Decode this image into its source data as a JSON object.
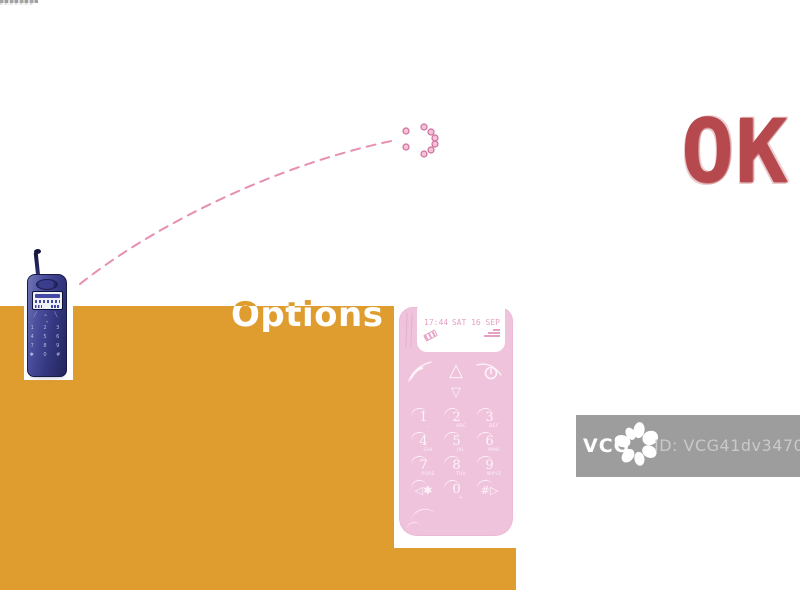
{
  "ok_label": "OK",
  "options_label": "Options",
  "emoticon": {
    "symbol": ":)"
  },
  "pink_phone": {
    "screen": {
      "time": "17:44",
      "date": "SAT 16 SEP"
    },
    "nav_up": "△",
    "nav_down": "▽",
    "keys": [
      {
        "num": "1",
        "sub": ".,"
      },
      {
        "num": "2",
        "sub": "ABC"
      },
      {
        "num": "3",
        "sub": "DEF"
      },
      {
        "num": "4",
        "sub": "GHI"
      },
      {
        "num": "5",
        "sub": "JKL"
      },
      {
        "num": "6",
        "sub": "MNO"
      },
      {
        "num": "7",
        "sub": "PQRS"
      },
      {
        "num": "8",
        "sub": "TUV"
      },
      {
        "num": "9",
        "sub": "WXYZ"
      },
      {
        "num": "◁✱",
        "sub": ""
      },
      {
        "num": "0",
        "sub": "+"
      },
      {
        "num": "#▷",
        "sub": ""
      }
    ]
  },
  "blue_phone": {
    "nav_row1": "╱ ▵ ╲",
    "nav_row2": "▿",
    "keypad_rows": [
      "1 2 3",
      "4 5 6",
      "7 8 9",
      "✱ 0 #"
    ]
  },
  "watermark": {
    "brand": "VCG",
    "id_text": "ID: VCG41dv347007"
  },
  "colors": {
    "orange": "#df9d2f",
    "pink_body": "#f0c3dc",
    "pink_accent": "#e5a0c5",
    "dash_pink": "#e78fb3",
    "ok_red": "#b5494d",
    "blue_dark": "#33377f",
    "badge_gray": "#9d9d9d"
  }
}
